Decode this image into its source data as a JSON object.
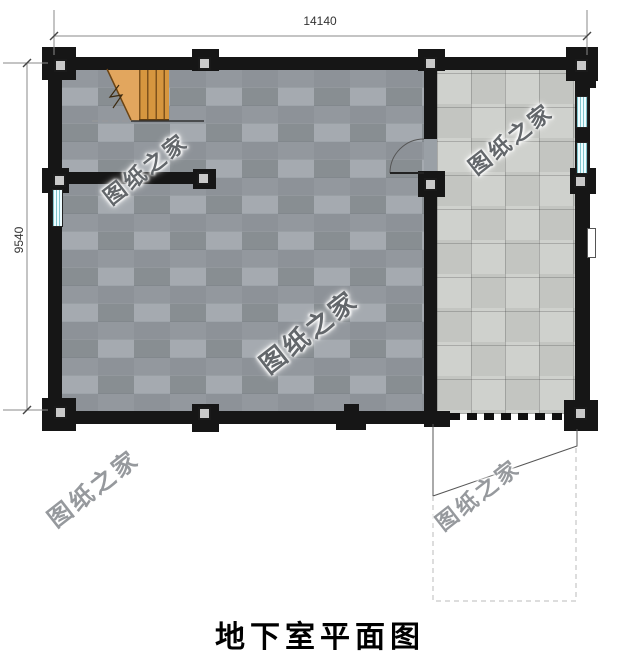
{
  "title": "地下室平面图",
  "dimensions": {
    "width_label": "14140",
    "height_label": "9540"
  },
  "watermark": {
    "text": "图纸之家"
  },
  "colors": {
    "wall": "#161616",
    "floor_main": "#9aa0a6",
    "floor_garage": "#cbcdc9",
    "wood": "#d6963f",
    "wood_light": "#e2a65e",
    "column_fill": "#c9c9c9",
    "window_glass": "#eefcff",
    "window_line": "#7fc4cc",
    "dimension_line": "#8a8a8a",
    "watermark_inside": "#63676b",
    "watermark_outside": "#96999d",
    "title_color": "#000000"
  }
}
